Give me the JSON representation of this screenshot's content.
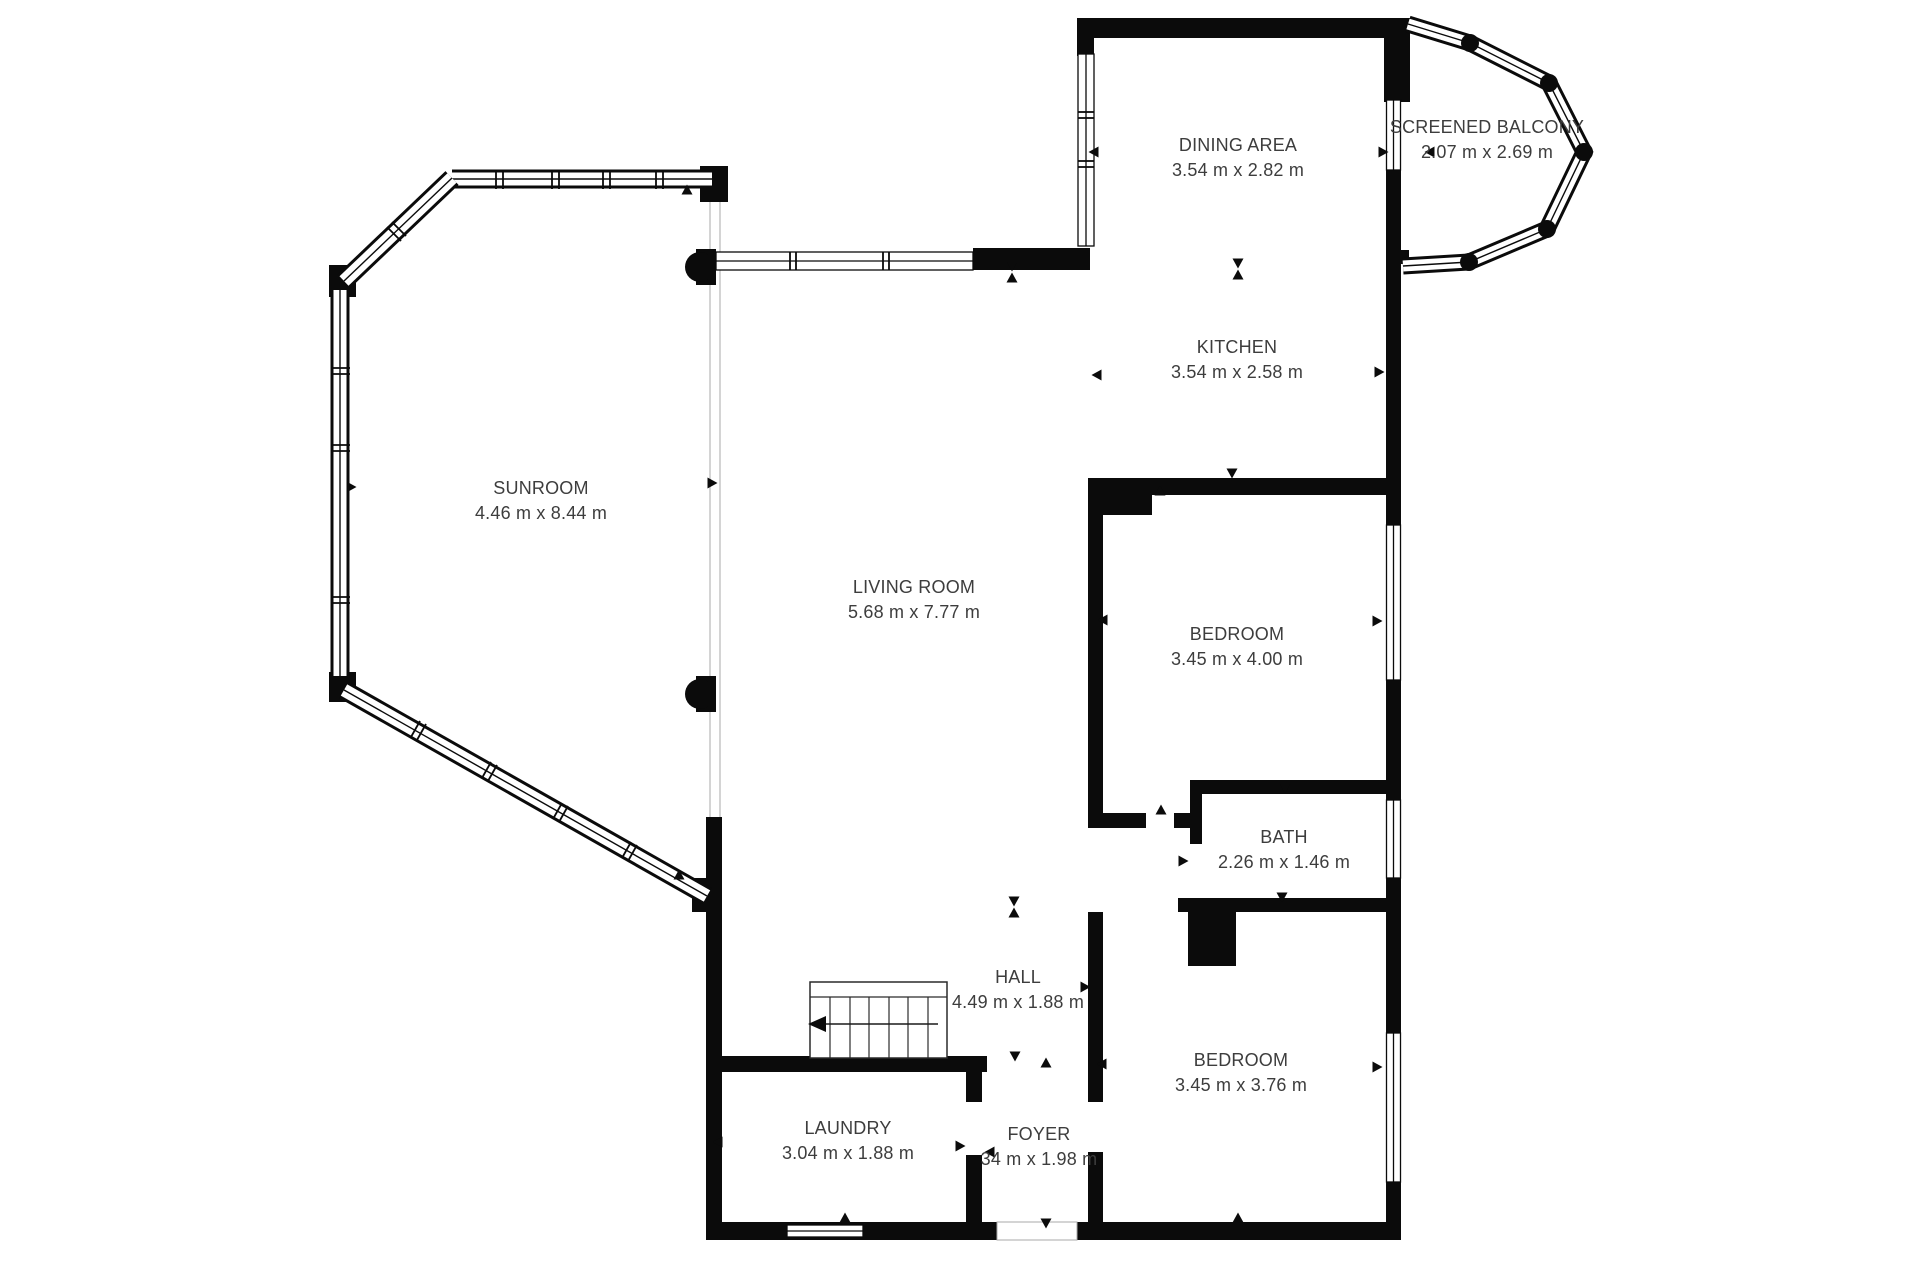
{
  "plan": {
    "type": "floor-plan",
    "background": "#ffffff",
    "wall_color": "#0b0b0b",
    "window_line_color": "#1a1a1a",
    "divider_line_color": "#bdbdbd",
    "text_color": "#3d3d3d",
    "rooms": [
      {
        "id": "sunroom",
        "name": "SUNROOM",
        "dims": "4.46 m x 8.44 m"
      },
      {
        "id": "living-room",
        "name": "LIVING ROOM",
        "dims": "5.68 m x 7.77 m"
      },
      {
        "id": "dining-area",
        "name": "DINING AREA",
        "dims": "3.54 m x 2.82 m"
      },
      {
        "id": "kitchen",
        "name": "KITCHEN",
        "dims": "3.54 m x 2.58 m"
      },
      {
        "id": "screened-balcony",
        "name": "SCREENED BALCONY",
        "dims": "2.07 m x 2.69 m"
      },
      {
        "id": "bedroom-1",
        "name": "BEDROOM",
        "dims": "3.45 m x 4.00 m"
      },
      {
        "id": "bath",
        "name": "BATH",
        "dims": "2.26 m x 1.46 m"
      },
      {
        "id": "bedroom-2",
        "name": "BEDROOM",
        "dims": "3.45 m x 3.76 m"
      },
      {
        "id": "hall",
        "name": "HALL",
        "dims": "4.49 m x 1.88 m"
      },
      {
        "id": "laundry",
        "name": "LAUNDRY",
        "dims": "3.04 m x 1.88 m"
      },
      {
        "id": "foyer",
        "name": "FOYER",
        "dims": "34 m x 1.98 m"
      }
    ]
  }
}
